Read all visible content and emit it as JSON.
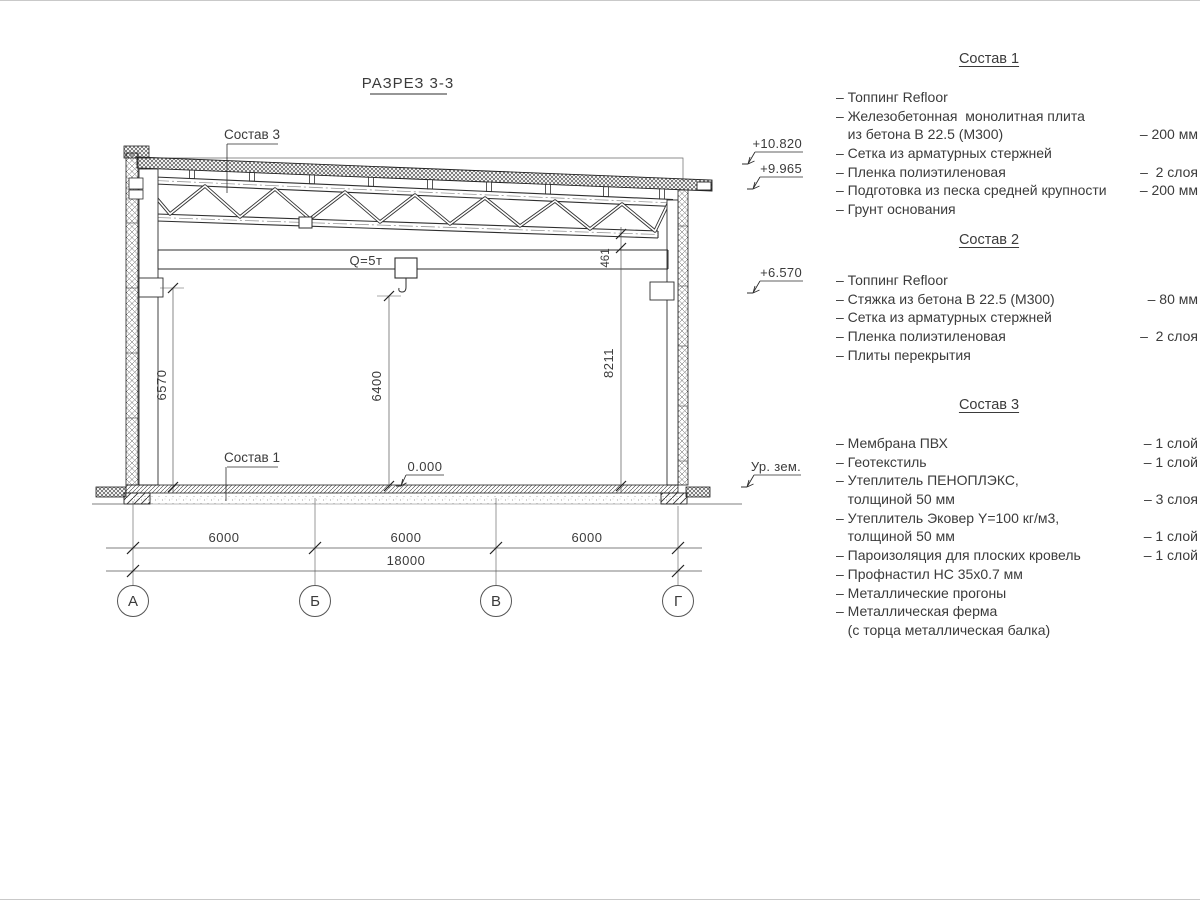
{
  "title": "РАЗРЕЗ 3-3",
  "drawing": {
    "labels": {
      "roof_callout": "Состав 3",
      "floor_callout": "Состав 1",
      "crane": "Q=5т",
      "zero_level": "0.000"
    },
    "elevations": {
      "roof_high": "+10.820",
      "roof_low": "+9.965",
      "crane_level": "+6.570",
      "ground": "Ур. зем."
    },
    "dimensions": {
      "left_height": "6570",
      "mid_height": "6400",
      "right_height": "8211",
      "truss_to_crane": "461",
      "span_ab": "6000",
      "span_bc": "6000",
      "span_cd": "6000",
      "total": "18000"
    },
    "axes": {
      "a": "А",
      "b": "Б",
      "c": "В",
      "d": "Г"
    }
  },
  "legend": {
    "sections": [
      {
        "title": "Состав 1",
        "rows": [
          {
            "text": "– Топпинг Refloor",
            "value": ""
          },
          {
            "text": "– Железобетонная  монолитная плита",
            "value": ""
          },
          {
            "text": "   из бетона В 22.5 (М300)",
            "value": "– 200 мм"
          },
          {
            "text": "– Сетка из арматурных стержней",
            "value": ""
          },
          {
            "text": "– Пленка полиэтиленовая",
            "value": "–  2 слоя"
          },
          {
            "text": "– Подготовка из песка средней крупности",
            "value": "– 200 мм"
          },
          {
            "text": "– Грунт основания",
            "value": ""
          }
        ]
      },
      {
        "title": "Состав 2",
        "rows": [
          {
            "text": "– Топпинг Refloor",
            "value": ""
          },
          {
            "text": "– Стяжка из бетона В 22.5 (М300)",
            "value": "– 80 мм"
          },
          {
            "text": "– Сетка из арматурных стержней",
            "value": ""
          },
          {
            "text": "– Пленка полиэтиленовая",
            "value": "–  2 слоя"
          },
          {
            "text": "– Плиты перекрытия",
            "value": ""
          }
        ]
      },
      {
        "title": "Состав 3",
        "rows": [
          {
            "text": "– Мембрана ПВХ",
            "value": "– 1 слой"
          },
          {
            "text": "– Геотекстиль",
            "value": "– 1 слой"
          },
          {
            "text": "– Утеплитель ПЕНОПЛЭКС,",
            "value": ""
          },
          {
            "text": "   толщиной 50 мм",
            "value": "– 3 слоя"
          },
          {
            "text": "– Утеплитель Эковер Y=100 кг/м3,",
            "value": ""
          },
          {
            "text": "   толщиной 50 мм",
            "value": "– 1 слой"
          },
          {
            "text": "– Пароизоляция для плоских кровель",
            "value": "– 1 слой"
          },
          {
            "text": "– Профнастил НС 35х0.7 мм",
            "value": ""
          },
          {
            "text": "– Металлические прогоны",
            "value": ""
          },
          {
            "text": "– Металлическая ферма",
            "value": ""
          },
          {
            "text": "   (с торца металлическая балка)",
            "value": ""
          }
        ]
      }
    ]
  }
}
